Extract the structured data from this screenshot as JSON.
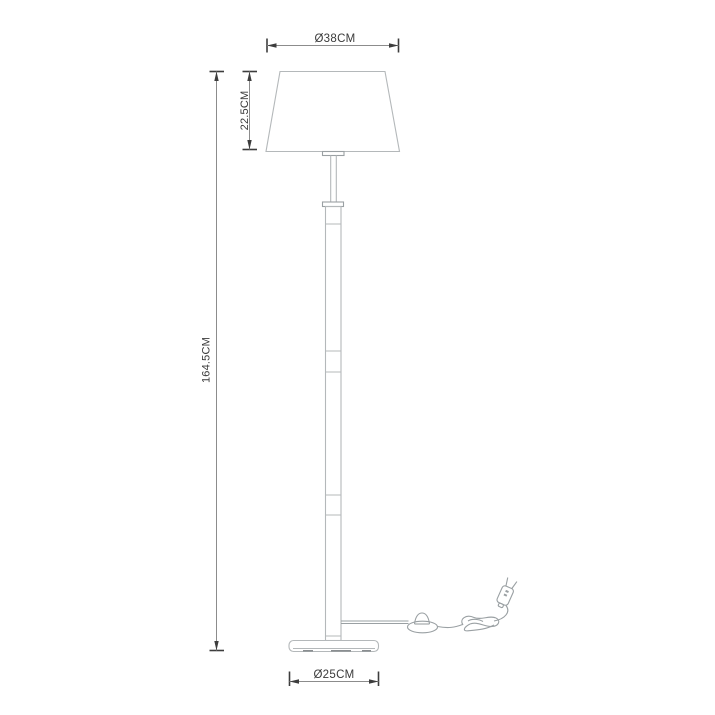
{
  "figure": {
    "subject": "floor-lamp-dimension-drawing",
    "labels": {
      "shade_diameter": "Ø38CM",
      "shade_height": "22.5CM",
      "total_height": "164.5CM",
      "base_diameter": "Ø25CM"
    }
  },
  "colors": {
    "background": "#ffffff",
    "lamp_outline": "#b4b8ba",
    "lamp_outline_dark": "#9aa0a3",
    "base_feet": "#8a8e91",
    "dimension_line": "#8c8c8c",
    "dimension_mark": "#3d3d3d",
    "label_text": "#3a3a3a"
  }
}
